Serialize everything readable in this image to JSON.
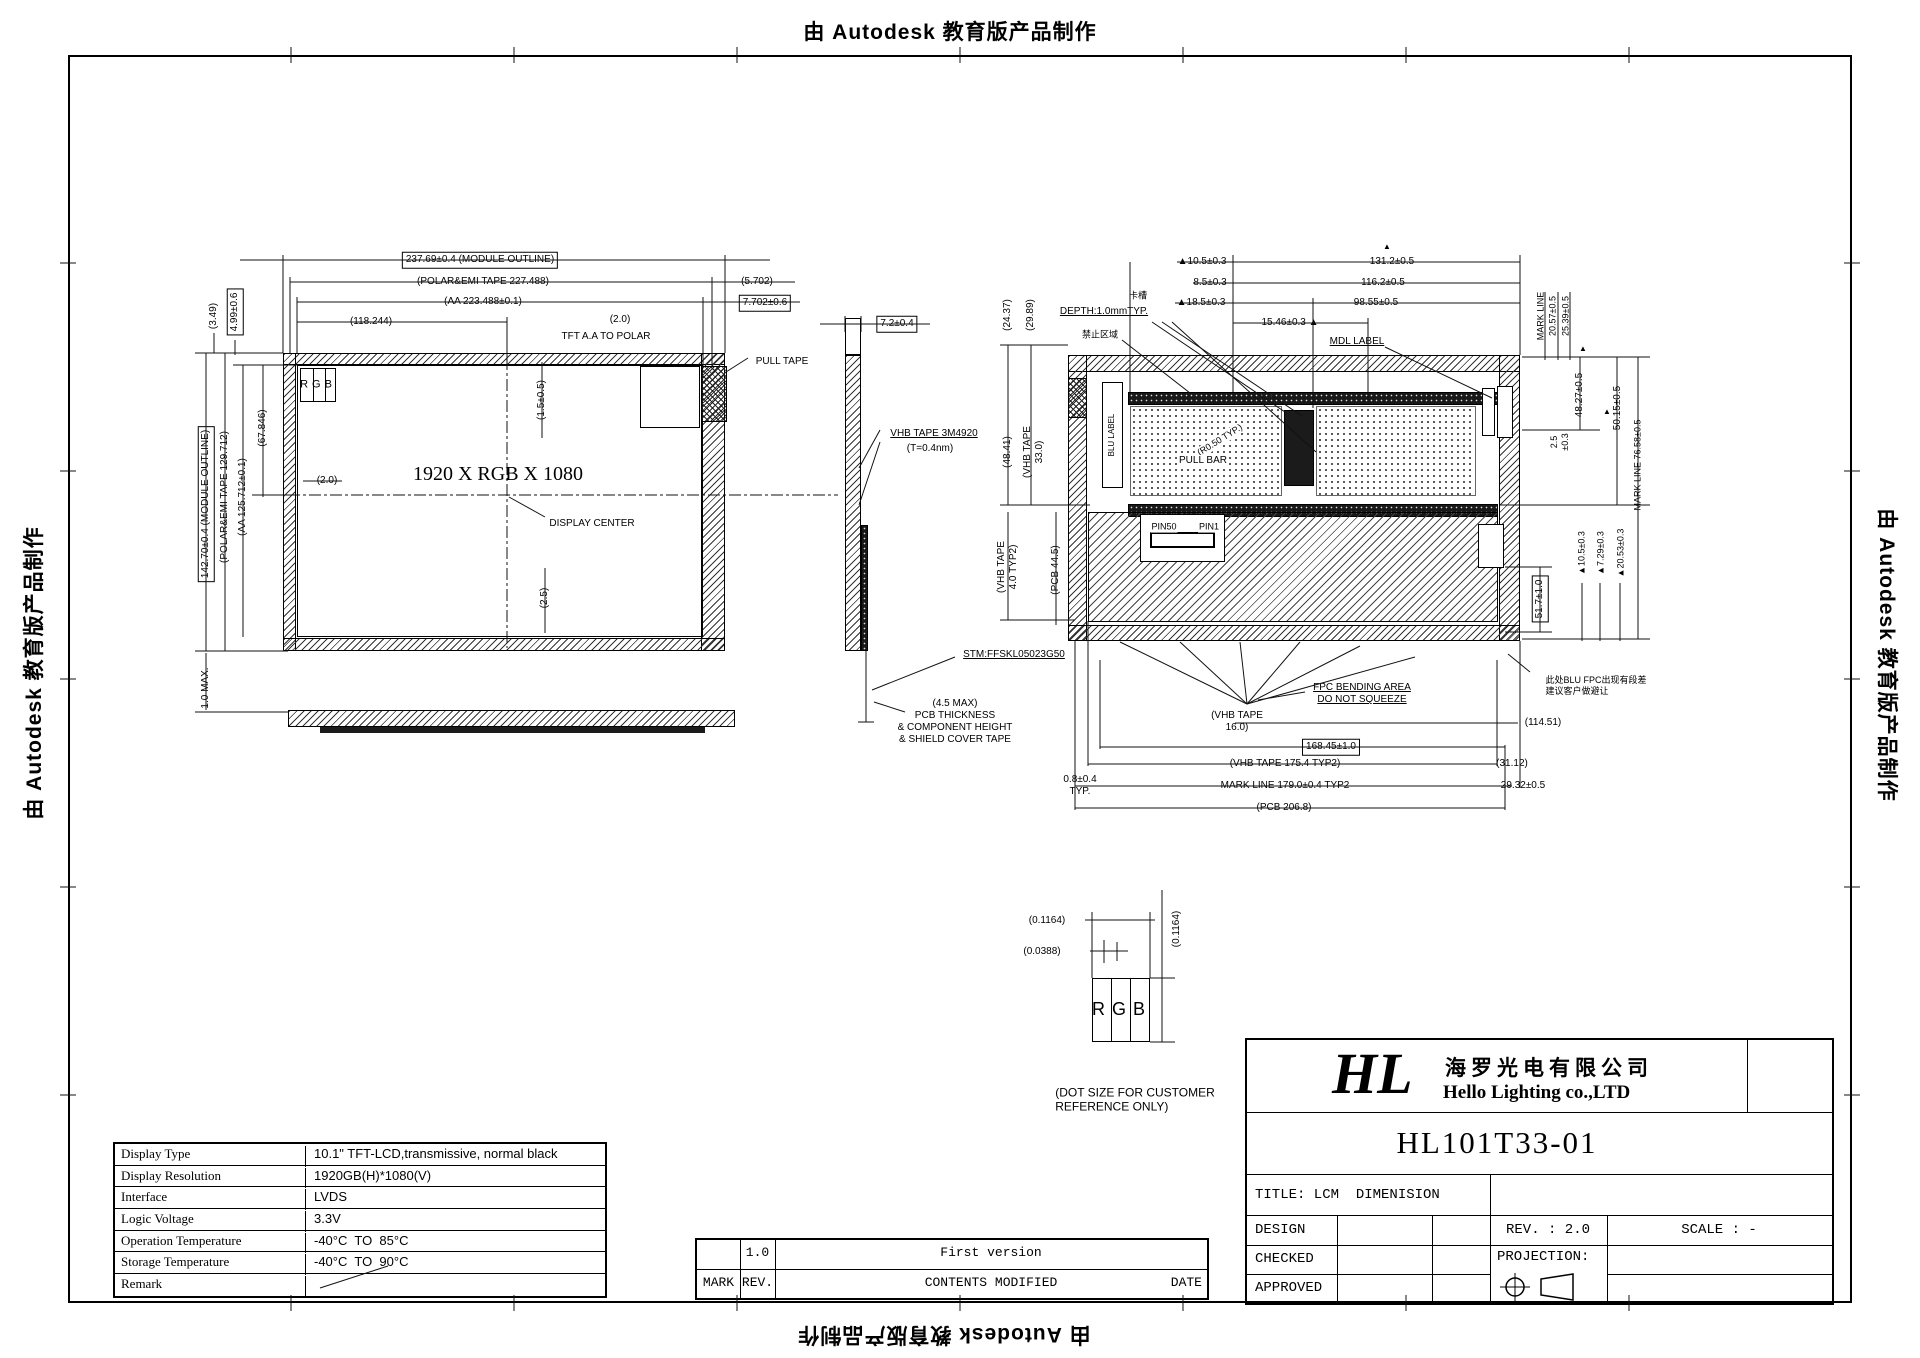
{
  "frame": {
    "autodesk_text": "由 Autodesk 教育版产品制作"
  },
  "front": {
    "module_w": "237.69±0.4 (MODULE OUTLINE)",
    "polar_w": "(POLAR&EMI TAPE 227.488)",
    "aa_w": "(AA 223.488±0.1)",
    "center_x": "(118.244)",
    "gap_2_0_top": "(2.0)",
    "tft_note": "TFT A.A TO POLAR",
    "dim_5702": "(5.702)",
    "dim_7702": "7.702±0.6",
    "pull_tape": "PULL TAPE",
    "dim_349": "(3.49)",
    "dim_499": "4.99±0.6",
    "module_h": "142.70±0.4 (MODULE OUTLINE)",
    "polar_h": "(POLAR&EMI TAPE 129.712)",
    "aa_h": "(AA 125.712±0.1)",
    "dim_67846": "(67.846)",
    "gap_2_0_left": "(2.0)",
    "max_1_0": "1.0 MAX.",
    "rgb": "RGB",
    "dim_1505": "(1.5±0.5)",
    "resolution": "1920 X RGB X 1080",
    "display_center": "DISPLAY CENTER",
    "dim_25": "(2.5)"
  },
  "side": {
    "dim_72": "7.2±0.4",
    "vhb_line1": "VHB TAPE 3M4920",
    "vhb_line2": "(T=0.4nm)",
    "stm": "STM:FFSKL05023G50",
    "note": "(4.5 MAX)\nPCB THICKNESS\n& COMPONENT HEIGHT\n& SHIELD COVER TAPE"
  },
  "back": {
    "dim_2437": "(24.37)",
    "dim_2989": "(29.89)",
    "dim_4841": "(48.41)",
    "vhb_33": "(VHB TAPE\n33.0)",
    "vhb_40": "(VHB TAPE\n4.0 TYP2)",
    "pcb_445": "(PCB 44.5)",
    "dim_105_left": "▲10.5±0.3",
    "tri": "▲",
    "dim_1312": "131.2±0.5",
    "dim_85": "8.5±0.3",
    "dim_1162": "116.2±0.5",
    "dim_185": "▲18.5±0.3",
    "dim_9855": "98.55±0.5",
    "dim_1546": "15.46±0.3 ▲",
    "depth_cn": "卡槽",
    "depth": "DEPTH:1.0mmTYP.",
    "keepout_cn": "禁止区域",
    "mdl_label": "MDL LABEL",
    "mark_line": "MARK LINE",
    "dim_2057": "20.57±0.5",
    "dim_2539": "25.39±0.5",
    "dim_25_03": "2.5\n±0.3",
    "dim_4827": "48.27±0.5",
    "dim_5015": "50.15±0.5",
    "mark_7658": "MARK LINE 76.58±0.5",
    "dim_105_right": "▲10.5±0.3",
    "dim_729": "▲7.29±0.3",
    "dim_2053": "▲20.53±0.3",
    "dim_517": "51.7±1.0",
    "note_cn": "此处BLU FPC出现有段差\n建议客户做避让",
    "dim_11451": "(114.51)",
    "blu_label": "BLU LABEL",
    "r050": "(R0.50 TYP.)",
    "pull_bar": "PULL BAR",
    "pin50": "PIN50",
    "pin1": "PIN1",
    "fpc_note": "FPC BENDING AREA\nDO NOT SQUEEZE",
    "vhb_16": "(VHB TAPE\n16.0)",
    "dim_16845": "168.45±1.0",
    "vhb_1754": "(VHB TAPE 175.4 TYP2)",
    "dim_3112": "(31.12)",
    "dim_08": "0.8±0.4\nTYP.",
    "mark_179": "MARK LINE 179.0±0.4 TYP2",
    "dim_2932": "29.32±0.5",
    "pcb_2068": "(PCB 206.8)"
  },
  "dot": {
    "w": "(0.1164)",
    "gap": "(0.0388)",
    "h": "(0.1164)",
    "rgb": "RGB",
    "caption": "(DOT SIZE FOR CUSTOMER\nREFERENCE ONLY)"
  },
  "spec": {
    "rows": [
      {
        "k": "Display Type",
        "v": "10.1\" TFT-LCD,transmissive, normal black"
      },
      {
        "k": "Display Resolution",
        "v": "1920GB(H)*1080(V)"
      },
      {
        "k": "Interface",
        "v": "LVDS"
      },
      {
        "k": "Logic Voltage",
        "v": "3.3V"
      },
      {
        "k": "Operation Temperature",
        "v": "-40°C  TO  85°C"
      },
      {
        "k": "Storage Temperature",
        "v": "-40°C  TO  90°C"
      },
      {
        "k": "Remark",
        "v": ""
      }
    ]
  },
  "rev_table": {
    "mark": "MARK",
    "rev": "REV.",
    "contents": "CONTENTS MODIFIED",
    "date": "DATE",
    "row_rev": "1.0",
    "row_contents": "First version"
  },
  "title_block": {
    "logo": "HL",
    "company_cn": "海罗光电有限公司",
    "company_en": "Hello Lighting co.,LTD",
    "model": "HL101T33-01",
    "title": "TITLE: LCM  DIMENISION",
    "design": "DESIGN",
    "checked": "CHECKED",
    "approved": "APPROVED",
    "rev": "REV. : 2.0",
    "scale": "SCALE : -",
    "projection": "PROJECTION:"
  }
}
